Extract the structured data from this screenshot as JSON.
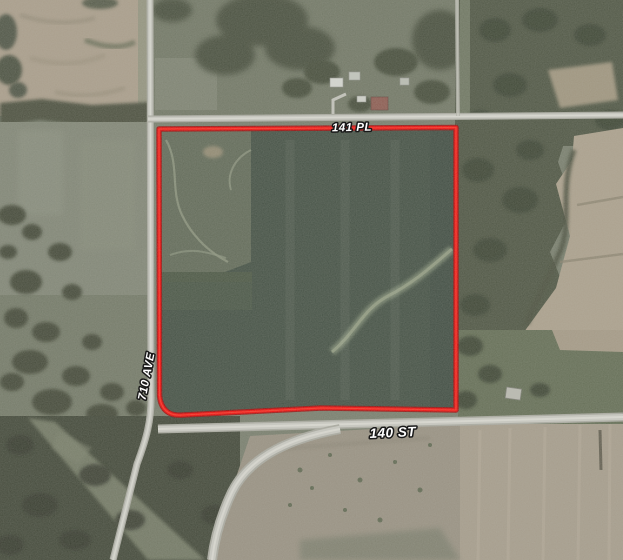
{
  "map": {
    "description": "Aerial parcel map with red boundary outline",
    "labels": {
      "top_road": "141 PL",
      "left_road": "710 AVE",
      "bottom_road": "140 ST"
    },
    "parcel_boundary_color": "#f40000",
    "colors": {
      "parcel_field": "#3d4a3e",
      "parcel_subfield": "#5c6553",
      "tan_field": "#a89b88",
      "pasture": "#7d8272",
      "woods": "#3b4132",
      "road": "#c9c9c2"
    }
  }
}
